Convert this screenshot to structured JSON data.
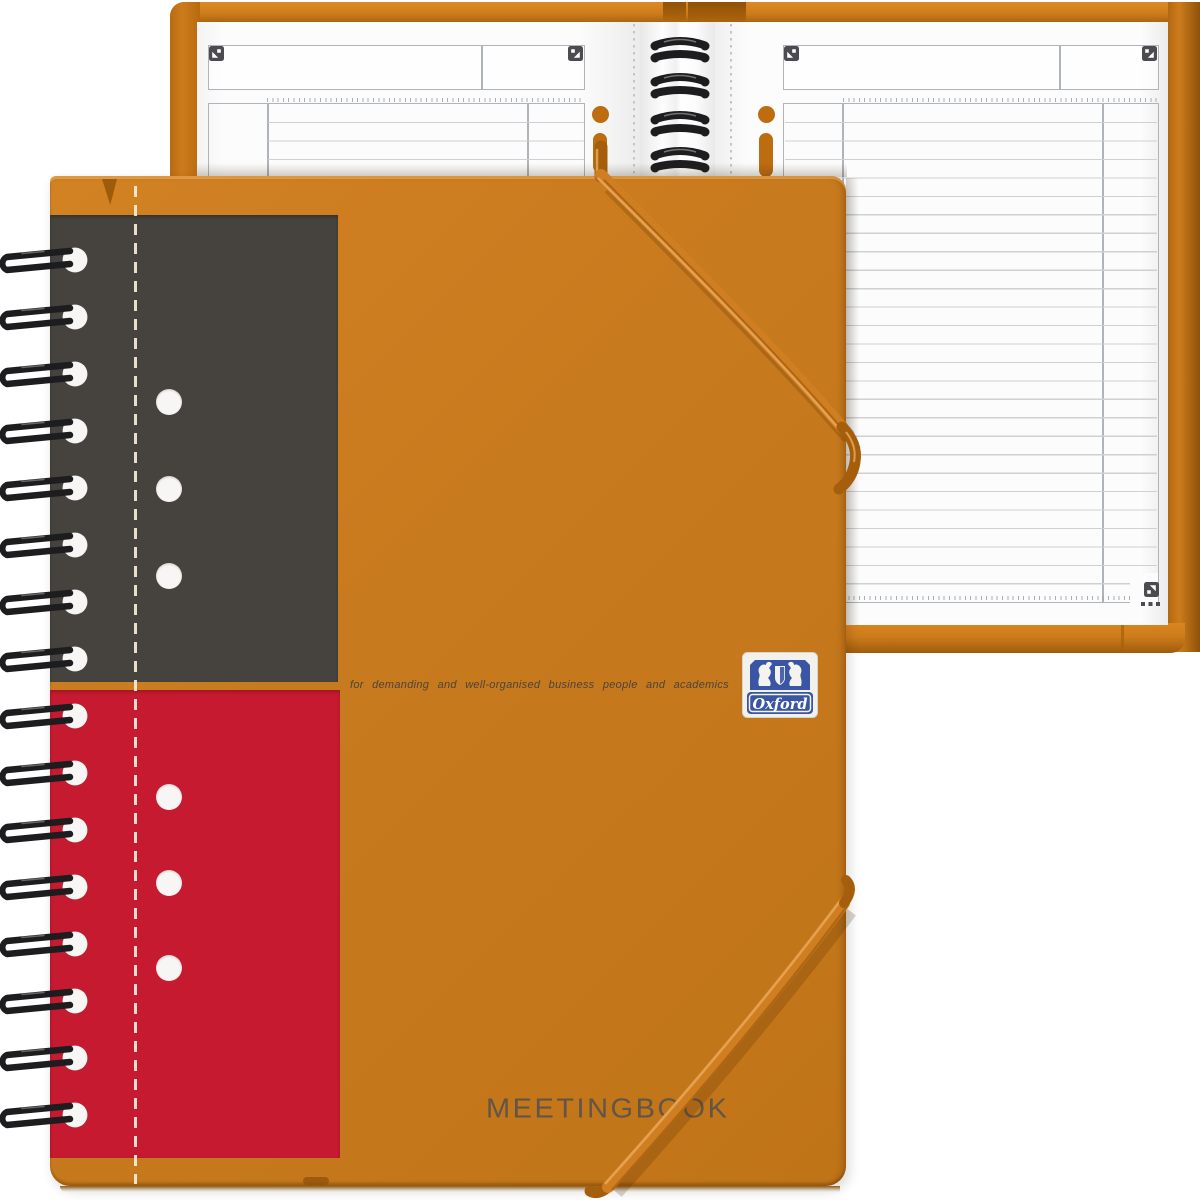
{
  "scene": {
    "type": "product-photo",
    "subject": "Oxford International Meetingbook spiral notebook, closed cover in front of an open notebook",
    "background": "#ffffff"
  },
  "colors": {
    "cover": "#c87a1e",
    "back_cover": "#cd7c1c",
    "gray_panel": "#46433e",
    "red_panel": "#c51a30",
    "hole_white": "#f7f6f4",
    "dash_line": "#f6ecd9",
    "page": "#fcfcfc",
    "rule": "#cdd0d4",
    "table_border": "#aeb4ba",
    "tick": "#9aa0a8",
    "scan_dark": "#4b4b50",
    "wire": "#1d1d1f",
    "band": "#cf7e22",
    "band_dark": "#a55f0c",
    "band_hi": "#e9a757",
    "tagline": "#4b443a",
    "title": "#59524b",
    "logo_blue": "#3a55a4",
    "logo_white": "#f2f1ec",
    "punch_orange": "#bd6c10"
  },
  "front": {
    "tagline": "for demanding and well-organised business people and academics",
    "title": "MEETINGBOOK",
    "coils": {
      "count": 16,
      "cx": 75,
      "start_y": 260,
      "step": 57
    },
    "holes": {
      "x": 169,
      "d": 26,
      "gray_y": [
        402,
        489,
        576
      ],
      "red_y": [
        797,
        883,
        968
      ]
    }
  },
  "logo": {
    "brand": "Oxford"
  },
  "back": {
    "coils": {
      "count": 4,
      "y": [
        50,
        86,
        124,
        160
      ]
    },
    "left_page": {
      "row_count": 4
    },
    "right_page": {
      "row_count": 26
    }
  }
}
